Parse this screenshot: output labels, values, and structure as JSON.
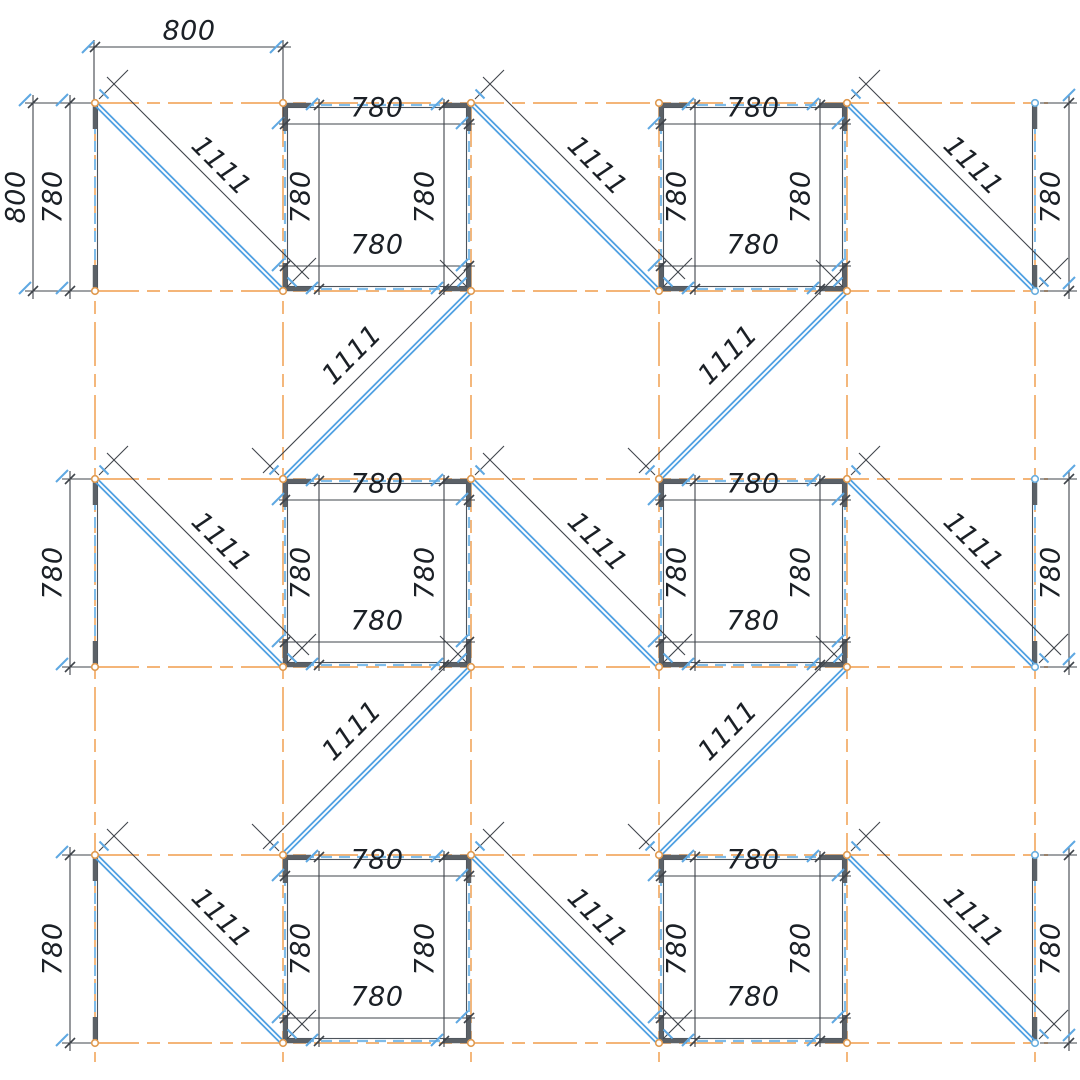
{
  "drawing": {
    "type": "structural-frame-plan",
    "canvas": {
      "width": 1080,
      "height": 1080,
      "background": "#ffffff"
    },
    "colors": {
      "centerline": "#f2ab66",
      "member_blue": "#4fa0e2",
      "member_blue_light": "#7fbce9",
      "steel_gray": "#5b6167",
      "edge_dark": "#4e545b",
      "dim_line": "#3f444b",
      "dim_text": "#1b2026",
      "tick_blue": "#5fa8e2",
      "node_stroke_orange": "#e09a50",
      "node_stroke_blue": "#6aaede",
      "node_fill": "#ffffff"
    },
    "grid": {
      "cols": [
        95,
        283,
        471,
        659,
        847,
        1035
      ],
      "rows": [
        103,
        291,
        479,
        667,
        855,
        1043
      ]
    },
    "dim_values": {
      "grid_pitch": "800",
      "panel_side": "780",
      "brace_length": "1111"
    },
    "panels": [
      {
        "col": 1,
        "band": 0
      },
      {
        "col": 3,
        "band": 0
      },
      {
        "col": 1,
        "band": 2
      },
      {
        "col": 3,
        "band": 2
      },
      {
        "col": 1,
        "band": 4
      },
      {
        "col": 3,
        "band": 4
      }
    ],
    "panel_edge_labels": [
      "780",
      "780",
      "780",
      "780"
    ],
    "braces_down": [
      {
        "col": 0,
        "band": 0
      },
      {
        "col": 2,
        "band": 0
      },
      {
        "col": 4,
        "band": 0
      },
      {
        "col": 0,
        "band": 2
      },
      {
        "col": 2,
        "band": 2
      },
      {
        "col": 4,
        "band": 2
      },
      {
        "col": 0,
        "band": 4
      },
      {
        "col": 2,
        "band": 4
      },
      {
        "col": 4,
        "band": 4
      }
    ],
    "braces_up": [
      {
        "col": 1,
        "band": 1
      },
      {
        "col": 3,
        "band": 1
      },
      {
        "col": 1,
        "band": 3
      },
      {
        "col": 3,
        "band": 3
      }
    ],
    "chords": [
      {
        "side": "left",
        "band": 0
      },
      {
        "side": "left",
        "band": 2
      },
      {
        "side": "left",
        "band": 4
      },
      {
        "side": "right",
        "band": 0
      },
      {
        "side": "right",
        "band": 2
      },
      {
        "side": "right",
        "band": 4
      }
    ],
    "edge_dims": {
      "top": [
        {
          "value": "800",
          "col": 0
        }
      ],
      "left": [
        {
          "value": "800",
          "band": 0,
          "line_x": 33,
          "label_x": 16
        },
        {
          "value": "780",
          "band": 0,
          "line_x": 70,
          "label_x": 53
        },
        {
          "value": "780",
          "band": 2,
          "line_x": 70,
          "label_x": 53
        },
        {
          "value": "780",
          "band": 4,
          "line_x": 70,
          "label_x": 53
        }
      ],
      "right": [
        {
          "value": "780",
          "band": 0,
          "line_x": 1069,
          "label_x": 1051
        },
        {
          "value": "780",
          "band": 2,
          "line_x": 1069,
          "label_x": 1051
        },
        {
          "value": "780",
          "band": 4,
          "line_x": 1069,
          "label_x": 1051
        }
      ]
    }
  }
}
